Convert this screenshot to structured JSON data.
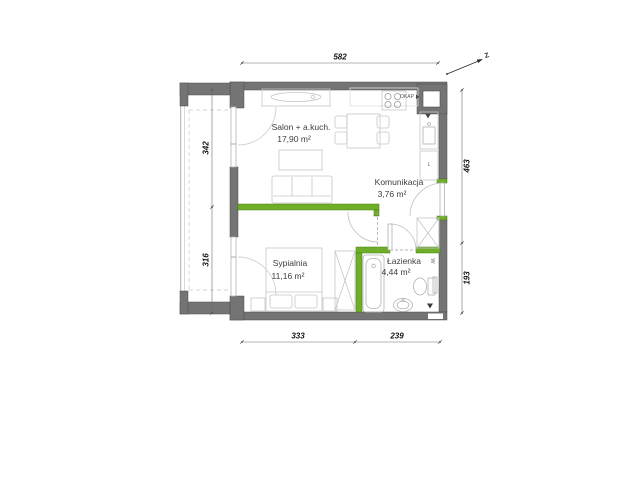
{
  "floorplan": {
    "compass": {
      "label": "Z"
    },
    "rooms": {
      "salon": {
        "name": "Salon + a.kuch.",
        "area": "17,90 m²"
      },
      "komunikacja": {
        "name": "Komunikacja",
        "area": "3,76 m²"
      },
      "sypialnia": {
        "name": "Sypialnia",
        "area": "11,16 m²"
      },
      "lazienka": {
        "name": "Łazienka",
        "area": "4,44 m²"
      }
    },
    "fixtures": {
      "hood": "OKAP",
      "fridge": "L",
      "washer": "W"
    },
    "dimensions_cm": {
      "top": "582",
      "left_upper": "342",
      "left_lower": "316",
      "right_upper": "463",
      "right_lower": "193",
      "bottom_left": "333",
      "bottom_right": "239"
    },
    "colors": {
      "wall": "#747474",
      "partition_green": "#6fae28",
      "furniture_line": "#c6c6c6",
      "dimension_text": "#151515"
    }
  }
}
